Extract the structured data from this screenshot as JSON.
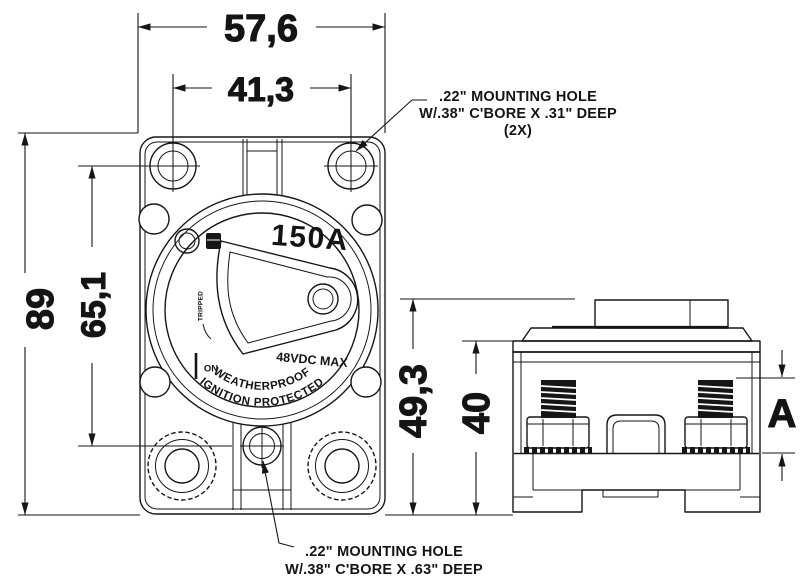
{
  "drawing": {
    "type": "circuit-breaker dimensional drawing",
    "dimensions": {
      "overall_width": "57,6",
      "mount_hole_spacing_h": "41,3",
      "overall_height": "89",
      "mount_hole_spacing_v": "65,1",
      "side_overall_height": "49,3",
      "side_body_height": "40",
      "stud_dim_label": "A"
    },
    "notes": {
      "top": {
        "line1": ".22\" MOUNTING HOLE",
        "line2": "W/.38\" C'BORE X .31\" DEEP",
        "line3": "(2X)"
      },
      "bottom": {
        "line1": ".22\" MOUNTING HOLE",
        "line2": "W/.38\" C'BORE X .63\" DEEP"
      }
    },
    "face": {
      "rating": "150A",
      "voltage": "48VDC MAX",
      "arc_line1": "WEATHERPROOF",
      "arc_line2": "IGNITION PROTECTED",
      "on_label": "ON",
      "tripped_label": "TRIPPED"
    },
    "colors": {
      "line": "#161616",
      "background": "#ffffff"
    }
  }
}
